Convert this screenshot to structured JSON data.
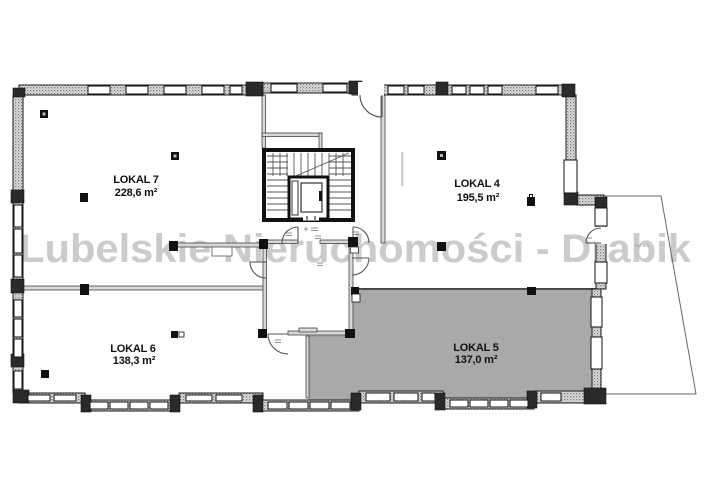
{
  "plan": {
    "watermark": "Lubelskie Nieruchomości - Drabik",
    "rooms": [
      {
        "id": "lokal-7",
        "name": "LOKAL 7",
        "area": "228,6 m²",
        "highlighted": false
      },
      {
        "id": "lokal-4",
        "name": "LOKAL 4",
        "area": "195,5 m²",
        "highlighted": false
      },
      {
        "id": "lokal-6",
        "name": "LOKAL 6",
        "area": "138,3 m²",
        "highlighted": false
      },
      {
        "id": "lokal-5",
        "name": "LOKAL 5",
        "area": "137,0 m²",
        "highlighted": true
      }
    ],
    "terrace_label": "taras",
    "colors": {
      "highlight_fill": "#a9a9a9",
      "watermark_color": "#c9c9c9",
      "wall": "#1a1a1a",
      "background": "#ffffff"
    }
  }
}
